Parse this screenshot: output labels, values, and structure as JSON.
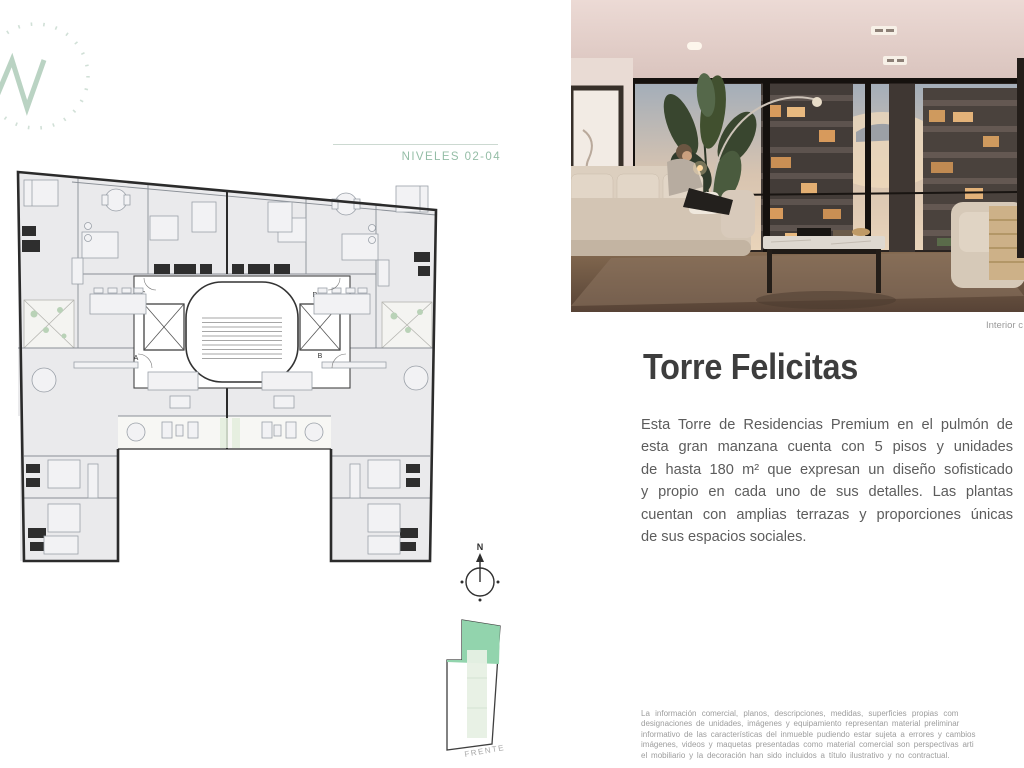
{
  "plan": {
    "level_label": "NIVELES 02-04",
    "unit_labels": [
      "A",
      "B",
      "C",
      "D"
    ],
    "compass_north_label": "N",
    "site_front_label": "FRENTE"
  },
  "photo": {
    "caption": "Interior c"
  },
  "article": {
    "title": "Torre Felicitas",
    "body_lines": [
      "Esta Torre de Residencias Premium en el pulmón de",
      "esta gran manzana cuenta con 5 pisos y unidades",
      "de hasta 180 m² que expresan un diseño sofisticado",
      "y propio en cada uno de sus detalles. Las plantas",
      "cuentan con amplias terrazas y proporciones únicas",
      "de sus espacios sociales."
    ]
  },
  "disclaimer": {
    "lines": [
      "La información comercial, planos, descripciones, medidas, superficies propias com",
      "designaciones de unidades, imágenes y equipamiento representan material preliminar",
      "informativo de las características del inmueble pudiendo estar sujeta a errores y cambios",
      "imágenes, videos y maquetas presentadas como material comercial son perspectivas arti",
      "el mobiliario y la decoración han sido incluidos a título ilustrativo y no contractual."
    ]
  },
  "colors": {
    "accent_green": "#94bda6",
    "site_green": "#92d4ad",
    "plan_wall": "#2b2b2b",
    "room_fill": "#eaeaec",
    "title_text": "#3d3d3d",
    "body_text": "#5c5c5c",
    "muted_text": "#9d9d9d"
  }
}
